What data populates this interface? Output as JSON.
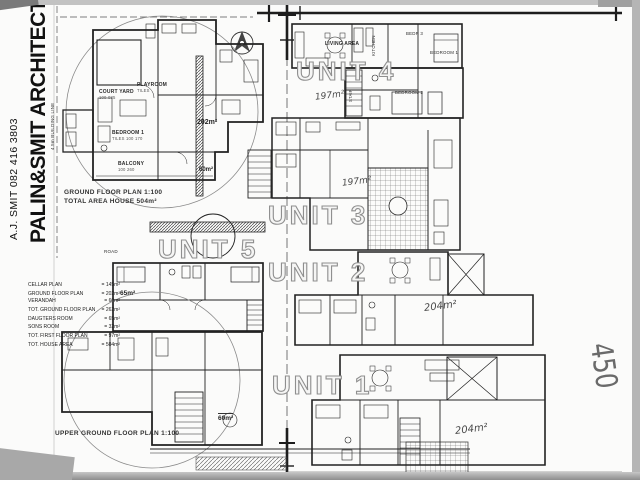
{
  "colors": {
    "ink": "#2b2b2b",
    "paper": "#fbfbfa",
    "scan_edge": "#a8a8a8",
    "outline_text": "#8f8f8f",
    "handwriting": "#4a4a4a"
  },
  "title_block": {
    "firm": "PALIN&SMIT ARCHITECTS",
    "contact": "A.J. SMIT 082 416 3803"
  },
  "site": {
    "building_line_top": "3.5m BUILDING LINE",
    "building_line_left": "4.5m BUILDING LINE",
    "road": "ROAD"
  },
  "captions": {
    "ground_floor_plan": "GROUND FLOOR PLAN 1:100",
    "total_area": "TOTAL AREA HOUSE 504m²",
    "upper_ground_floor_plan": "UPPER GROUND FLOOR PLAN 1:100"
  },
  "area_schedule": {
    "rows": [
      {
        "label": "CELLAR PLAN",
        "value": "= 145m²"
      },
      {
        "label": "GROUND FLOOR PLAN",
        "value": "= 202m²"
      },
      {
        "label": "VERANDAH",
        "value": "= 60m²"
      },
      {
        "label": "TOT. GROUND FLOOR PLAN",
        "value": "= 262m²"
      },
      {
        "label": "DAUGTERS ROOM",
        "value": "= 65m²"
      },
      {
        "label": "SONS ROOM",
        "value": "= 32m²"
      },
      {
        "label": "TOT. FIRST FLOOR PLAN",
        "value": "= 97m²"
      },
      {
        "label": "TOT. HOUSE AREA",
        "value": "= 504m²"
      }
    ]
  },
  "units": {
    "unit1": {
      "label": "UNIT 1",
      "area": "204m²"
    },
    "unit2": {
      "label": "UNIT 2",
      "area": "204m²"
    },
    "unit3": {
      "label": "UNIT 3",
      "area": "197m²"
    },
    "unit4": {
      "label": "UNIT 4",
      "area": "197m²"
    },
    "unit5": {
      "label": "UNIT 5"
    }
  },
  "ground_plan": {
    "court_yard": "COURT YARD",
    "court_yard_sub": "100 085",
    "playroom": "PLAYROOM",
    "playroom_sub": "TILES",
    "bedroom1": "BEDROOM 1",
    "bedroom1_sub": "TILES 100 170",
    "balcony": "BALCONY",
    "balcony_sub": "100 260",
    "area_living": "202m²",
    "area_verandah": "60m²"
  },
  "first_floor": {
    "area": "65m²"
  },
  "upper_plan": {
    "area": "60m²"
  },
  "unit4_rooms": {
    "living_area": "LIVING AREA",
    "kitchen": "KITCHEN",
    "bedr3": "BEDR 3",
    "bedroom1": "BEDROOM 1",
    "bedroom2": "BEDROOM 2",
    "stair": "STAIR"
  },
  "handwritten": {
    "sketch": "450"
  }
}
